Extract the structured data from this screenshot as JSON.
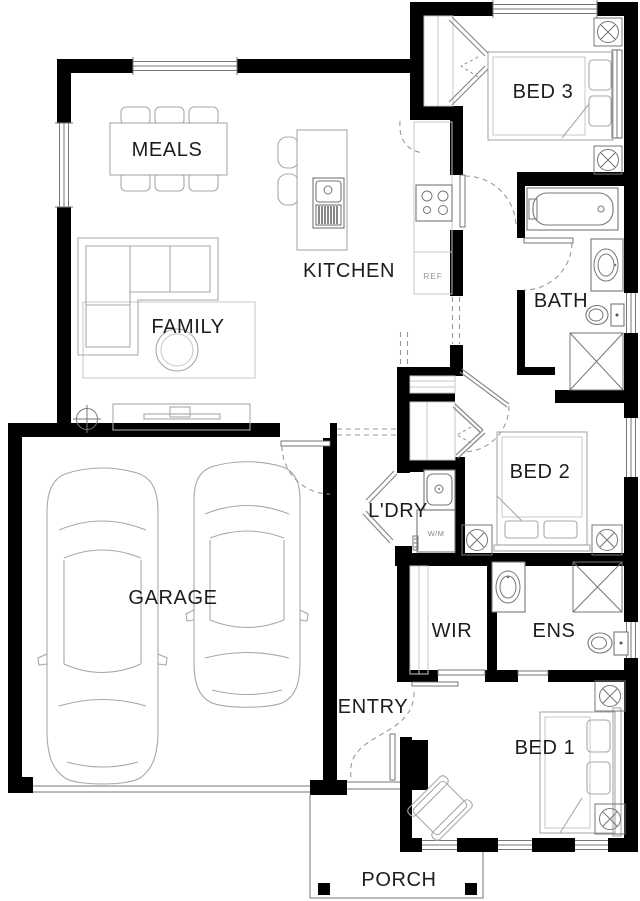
{
  "rooms": {
    "meals": {
      "label": "MEALS"
    },
    "kitchen": {
      "label": "KITCHEN"
    },
    "family": {
      "label": "FAMILY"
    },
    "garage": {
      "label": "GARAGE"
    },
    "bed3": {
      "label": "BED 3"
    },
    "bath": {
      "label": "BATH"
    },
    "bed2": {
      "label": "BED 2"
    },
    "laundry": {
      "label": "L'DRY"
    },
    "wir": {
      "label": "WIR"
    },
    "ens": {
      "label": "ENS"
    },
    "entry": {
      "label": "ENTRY"
    },
    "bed1": {
      "label": "BED 1"
    },
    "porch": {
      "label": "PORCH"
    }
  },
  "appliances": {
    "fridge_label": "REF",
    "washing_machine_label": "W/M"
  },
  "colors": {
    "wall": "#000000",
    "furniture_line": "#a8a8a8",
    "fixture_line": "#777777",
    "label_text": "#1d1d1d",
    "muted_label": "#9a9a9a",
    "background": "#ffffff"
  }
}
